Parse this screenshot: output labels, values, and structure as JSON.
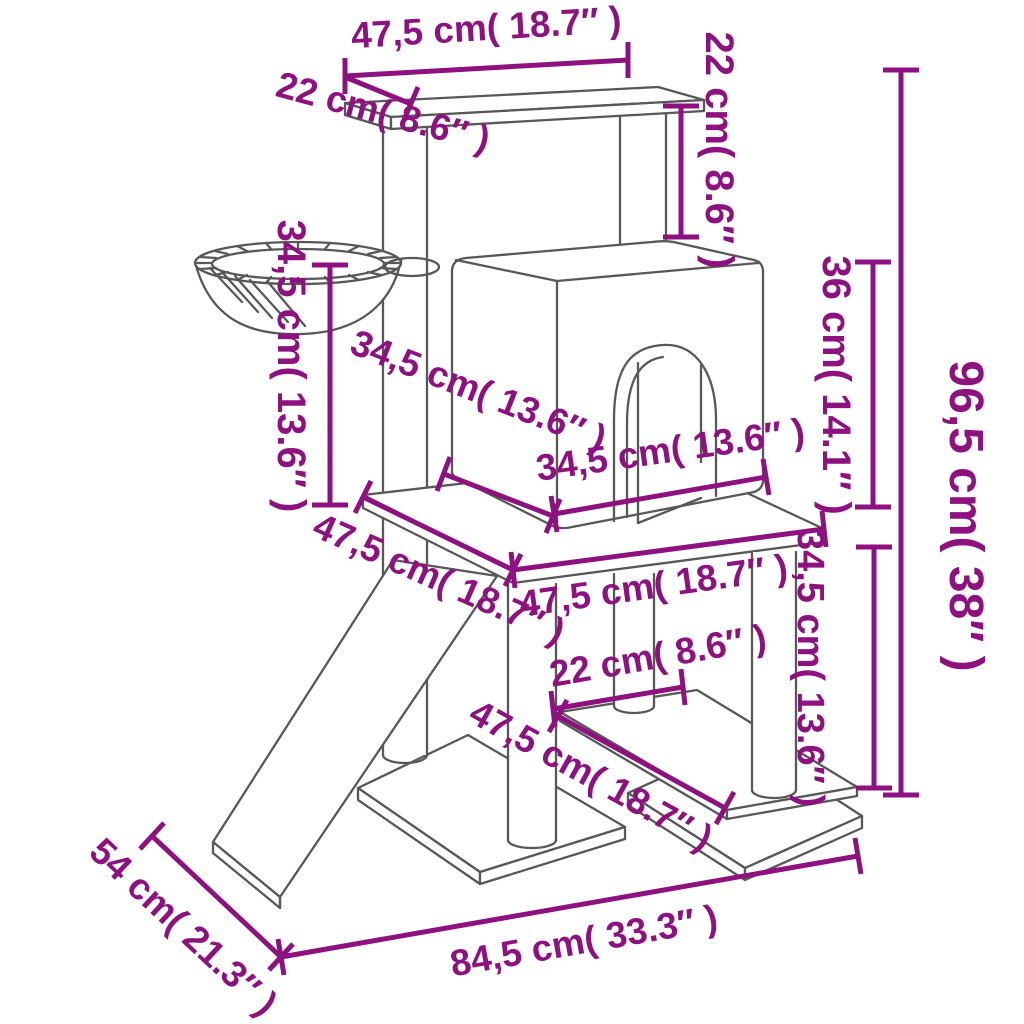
{
  "diagram": {
    "kind": "product-dimension-diagram",
    "subject": "cat tree with scratching posts, house, basket and ramp",
    "accent_color": "#8d1280",
    "line_color": "#585858",
    "background_color": "#ffffff"
  },
  "dims": {
    "top_shelf_width": "47,5 cm( 18.7″ )",
    "top_shelf_depth": "22 cm( 8.6″ )",
    "top_to_house_gap": "22 cm( 8.6″ )",
    "basket_post_height": "34,5 cm( 13.6″ )",
    "house_depth": "34,5 cm( 13.6″ )",
    "house_width": "34,5 cm( 13.6″ )",
    "house_height": "36 cm( 14.1″ )",
    "total_height": "96,5 cm( 38″ )",
    "platform_depth": "47,5 cm( 18.7″ )",
    "platform_width": "47,5 cm( 18.7″ )",
    "lower_shelf_gap": "22 cm( 8.6″ )",
    "lower_shelf_length": "47,5 cm( 18.7″ )",
    "lower_section_height": "34,5 cm( 13.6″ )",
    "base_depth": "54 cm( 21.3″ )",
    "base_width": "84,5 cm( 33.3″ )"
  }
}
